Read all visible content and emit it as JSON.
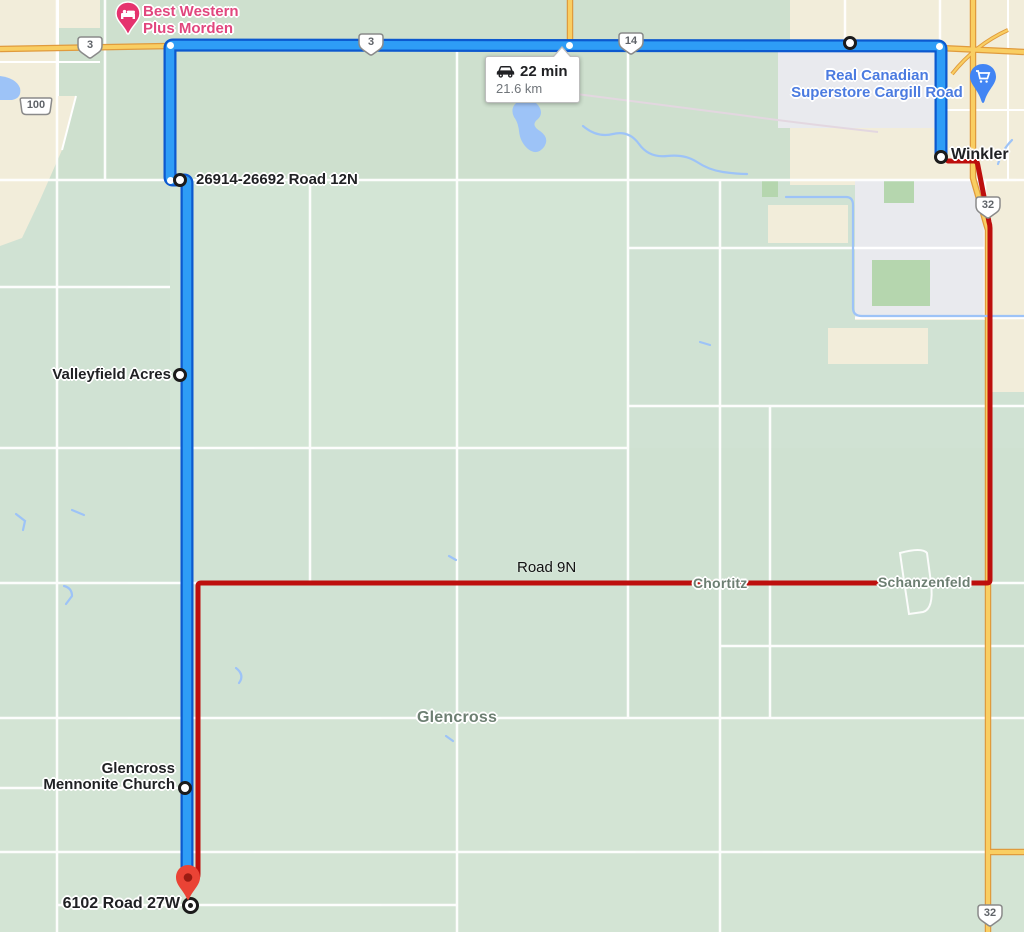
{
  "map": {
    "tooltip": {
      "duration": "22 min",
      "distance": "21.6 km"
    },
    "poi": {
      "hotel_line1": "Best Western",
      "hotel_line2": "Plus Morden",
      "store_line1": "Real Canadian",
      "store_line2": "Superstore Cargill Road"
    },
    "waypoints": {
      "road12n": "26914-26692 Road 12N",
      "valleyfield": "Valleyfield Acres",
      "church_line1": "Glencross",
      "church_line2": "Mennonite Church",
      "destination": "6102 Road 27W",
      "winkler": "Winkler"
    },
    "places": {
      "chortitz": "Chortitz",
      "schanzenfeld": "Schanzenfeld",
      "glencross": "Glencross"
    },
    "roads": {
      "road9n": "Road 9N"
    },
    "shields": [
      "3",
      "3",
      "100",
      "14",
      "32",
      "32"
    ],
    "icons": {
      "car": "car-icon",
      "bed": "bed-icon",
      "cart": "shopping-cart-icon"
    },
    "colors": {
      "route_blue": "#2E9DF6",
      "route_blue_casing": "#0C59CF",
      "route_red": "#BD0F0D",
      "map_green": "#D0E2D3",
      "urban_beige": "#F2EDDA",
      "urban_gray": "#E9EAEE",
      "road_yellow": "#F9CE62",
      "road_yellow_casing": "#E09B3D",
      "water_blue": "#9DC3F7",
      "pin_red": "#EA4335",
      "pin_pink": "#E5336E",
      "pin_blue": "#4285F4",
      "label_dark": "#202124",
      "label_place_gray": "#6D7F72",
      "label_pink": "#E1477E",
      "label_blue": "#4B7BE0"
    }
  }
}
